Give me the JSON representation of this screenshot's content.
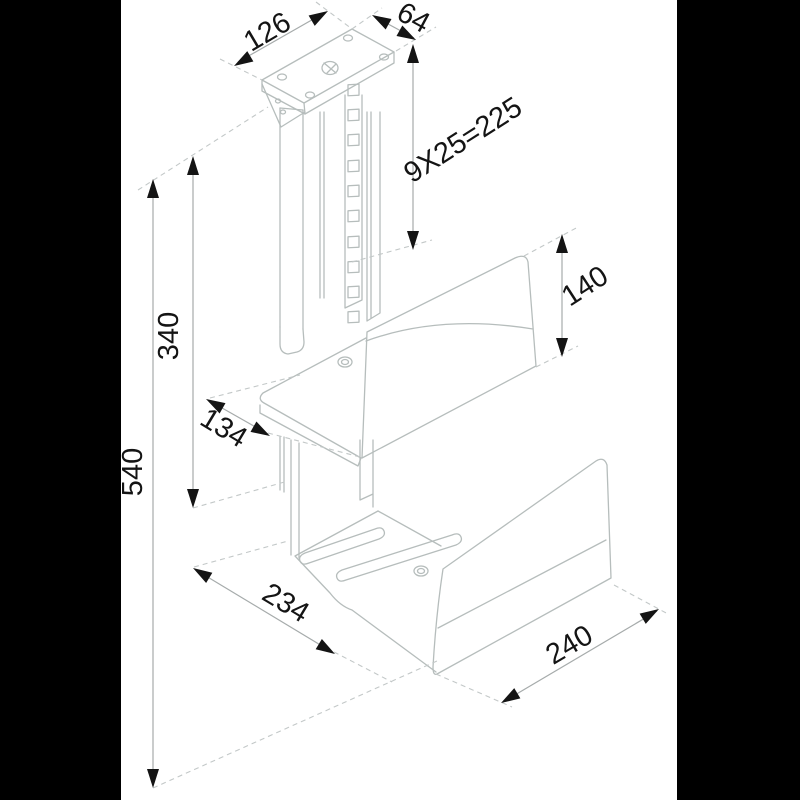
{
  "drawing": {
    "kind": "isometric dimension drawing",
    "subject": "height-adjustable ceiling/under-desk CPU holder with mounting plate, slotted column and two clamp brackets"
  },
  "colors": {
    "background": "#000000",
    "paper": "#ffffff",
    "line": "#b6bdbc",
    "dim_line": "#a6abab",
    "extension_dash": "#c3c8c8",
    "ink": "#141414"
  },
  "dimensions": [
    {
      "id": "plate-width",
      "text": "126"
    },
    {
      "id": "plate-depth",
      "text": "64"
    },
    {
      "id": "slot-pitch-total",
      "text": "9X25=225"
    },
    {
      "id": "column-travel",
      "text": "340"
    },
    {
      "id": "upper-panel-height",
      "text": "140"
    },
    {
      "id": "upper-shelf-depth",
      "text": "134"
    },
    {
      "id": "overall-height",
      "text": "540"
    },
    {
      "id": "tray-width",
      "text": "234"
    },
    {
      "id": "tray-depth",
      "text": "240"
    }
  ]
}
